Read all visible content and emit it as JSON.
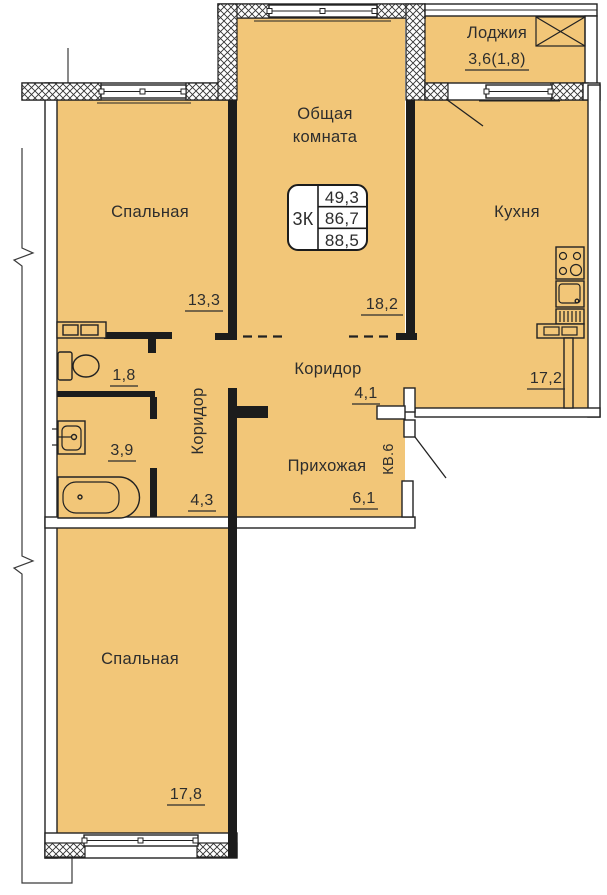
{
  "unit_label": "КВ.6",
  "info_box": {
    "rooms": "3К",
    "living_area": "49,3",
    "area_without_loggia": "86,7",
    "total_area": "88,5"
  },
  "rooms": {
    "loggia": {
      "name": "Лоджия",
      "area": "3,6(1,8)"
    },
    "common_room": {
      "name_line1": "Общая",
      "name_line2": "комната",
      "area": "18,2"
    },
    "bedroom_top": {
      "name": "Спальная",
      "area": "13,3"
    },
    "kitchen": {
      "name": "Кухня",
      "area": "17,2"
    },
    "corridor_main": {
      "name": "Коридор",
      "area": "4,1"
    },
    "corridor_small": {
      "name": "Коридор",
      "area": "4,3"
    },
    "hallway": {
      "name": "Прихожая",
      "area": "6,1"
    },
    "wc": {
      "area": "1,8"
    },
    "bathroom": {
      "area": "3,9"
    },
    "bedroom_bottom": {
      "name": "Спальная",
      "area": "17,8"
    }
  },
  "colors": {
    "floor": "#F2C678",
    "wall": "#1C1C1C",
    "line": "#2D2D2D",
    "background": "#FFFFFF"
  }
}
